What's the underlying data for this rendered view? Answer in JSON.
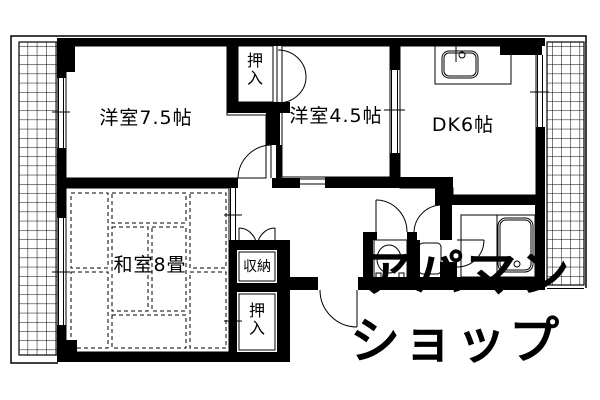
{
  "plan_type": "floorplan",
  "rooms": {
    "western_7_5": {
      "label": "洋室7.5帖"
    },
    "western_4_5": {
      "label": "洋室4.5帖"
    },
    "dk": {
      "label": "DK6帖"
    },
    "japanese_8": {
      "label": "和室8畳"
    },
    "closet_top": {
      "label": "押入"
    },
    "storage": {
      "label": "収納"
    },
    "closet_bottom": {
      "label": "押入"
    }
  },
  "watermark": {
    "line1": "アパマン",
    "line2": "ショップ",
    "color": "#e4e6ee"
  },
  "icons": [
    "kitchen-sink-icon",
    "bathtub-icon",
    "toilet-icon",
    "washstand-icon",
    "door-arc-icon",
    "balcony-hatch-icon"
  ],
  "colors": {
    "line": "#000000",
    "background": "#ffffff"
  }
}
